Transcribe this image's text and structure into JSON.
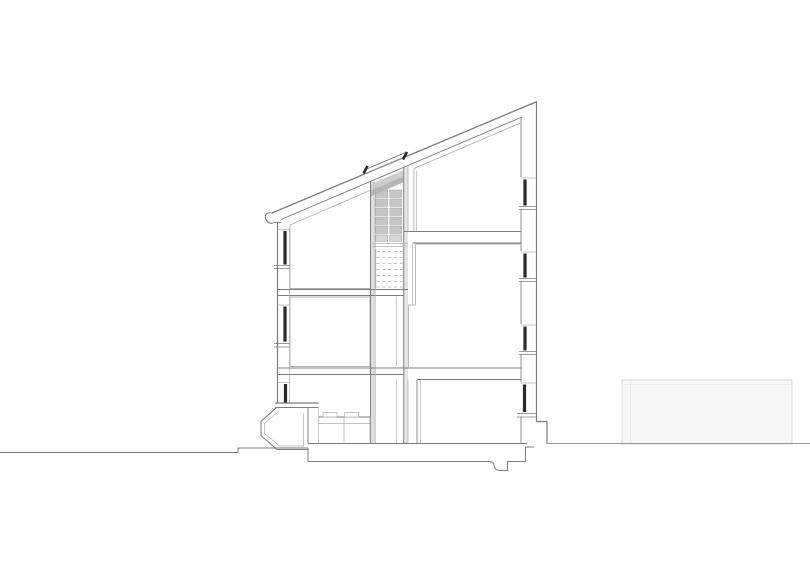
{
  "canvas": {
    "width": 810,
    "height": 570,
    "background": "#ffffff"
  },
  "drawing": {
    "kind": "architectural-building-cross-section",
    "colors": {
      "main": "#7d7d7d",
      "mid": "#989898",
      "light": "#b3b3b3",
      "faint": "#d8d8d4",
      "fainter": "#e6e6e2",
      "dark": "#2a2a2a",
      "white": "#ffffff",
      "none": "none",
      "shelf": "#c6c6c6",
      "shelf_last": "#d8d8d8",
      "band_left": "#dedede",
      "band_right": "#e4e4e4",
      "trap_light": "#cdcdcd",
      "trap_dark": "#b6b6b6",
      "neighbor": "#f7f7f5"
    },
    "layers": [
      {
        "type": "paths",
        "name": "background-context",
        "items": [
          {
            "n": "neighbor-building-block",
            "d": "M622,380 H792 V444 H622 Z",
            "s": "faint",
            "w": 1,
            "f": "neighbor"
          },
          {
            "n": "neighbor-building-parapet-line",
            "d": "M622,384.5 H792",
            "s": "fainter",
            "w": 0.8
          },
          {
            "n": "neighbor-building-edge-line",
            "d": "M630.5,380 V444",
            "s": "fainter",
            "w": 0.8
          },
          {
            "n": "ground-line-left",
            "d": "M0,452.5 H238 V448 H308",
            "s": "main",
            "w": 1.1
          },
          {
            "n": "ground-line-right",
            "d": "M547,443.5 H810",
            "s": "mid",
            "w": 1
          }
        ]
      },
      {
        "type": "paths",
        "name": "shaft-fills",
        "items": [
          {
            "n": "stair-shaft-left-wall-fill",
            "d": "M370.5,181.5 H375.2 V443 H370.5 Z",
            "s": "none",
            "w": 0,
            "f": "band_left"
          },
          {
            "n": "stair-shaft-right-wall-fill",
            "d": "M403.7,167.5 H408 V443 H403.7 Z",
            "s": "none",
            "w": 0,
            "f": "band_right"
          }
        ]
      },
      {
        "type": "grid",
        "name": "shelf-grid",
        "x": 375.8,
        "colOffsets": [
          0,
          14
        ],
        "colW": 11.8,
        "rowYs": [
          190,
          199,
          208,
          217,
          226,
          235
        ],
        "rowHs": [
          7.4,
          7.4,
          7.4,
          7.4,
          7.4,
          6.3
        ],
        "fills": [
          "shelf",
          "shelf",
          "shelf",
          "shelf",
          "shelf",
          "shelf_last"
        ],
        "stroke": "mid",
        "sw": 0.5
      },
      {
        "type": "paths",
        "name": "skylight-shaft-slope",
        "items": [
          {
            "n": "skylight-reveal-upper",
            "d": "M371,184 L403,170.5 V176.5 L371,190.5 Z",
            "s": "none",
            "w": 0,
            "f": "trap_light"
          },
          {
            "n": "skylight-reveal-lower",
            "d": "M371,190.5 L403,176.5 V182.5 L371,196.5 Z",
            "s": "none",
            "w": 0,
            "f": "trap_dark"
          }
        ]
      },
      {
        "type": "dashes",
        "name": "stair-run-panel",
        "x1": 376.5,
        "x2": 402.5,
        "ys": [
          251.5,
          257.5,
          263.5,
          269.5,
          275.5,
          281.5,
          287
        ],
        "stroke": "light",
        "w": 0.8,
        "dash": "3.2,2.6"
      },
      {
        "type": "paths",
        "name": "structure-lines",
        "items": [
          {
            "n": "roof-top-line",
            "d": "M272,213 L537,101.5",
            "s": "main",
            "w": 1.3
          },
          {
            "n": "roof-soffit-line",
            "d": "M281,219.5 L522,117",
            "s": "main",
            "w": 0.9
          },
          {
            "n": "gutter-hook",
            "d": "M273,213.5 C268,211.5 264.5,214 265.5,218.5 C266.5,222.5 271,224.5 273.5,222.5",
            "s": "main",
            "w": 1
          },
          {
            "n": "eave-underside",
            "d": "M273.5,222.5 H281.5",
            "s": "main",
            "w": 0.9
          },
          {
            "n": "left-wall-outer",
            "d": "M277.5,222 V403",
            "s": "main",
            "w": 1.2
          },
          {
            "n": "left-wall-inner",
            "d": "M289.5,227.5 V403",
            "s": "light",
            "w": 0.75
          },
          {
            "n": "attic-left-room-outline",
            "d": "M290,288.5 V225 L371,190 M290,288.5 H371",
            "s": "light",
            "w": 0.9
          },
          {
            "n": "slab-left-upper-top",
            "d": "M277.5,289.5 H408",
            "s": "main",
            "w": 0.95
          },
          {
            "n": "slab-left-upper-bottom",
            "d": "M277.5,295.5 H404",
            "s": "main",
            "w": 0.9
          },
          {
            "n": "mid-left-room-outline",
            "d": "M290,297 H370 V366.5 H290 Z",
            "s": "light",
            "w": 0.9
          },
          {
            "n": "slab-main-top",
            "d": "M277.5,368 H521",
            "s": "main",
            "w": 1
          },
          {
            "n": "slab-main-bottom-left",
            "d": "M277.5,374.5 H404",
            "s": "main",
            "w": 0.9
          },
          {
            "n": "slab-main-bottom-right",
            "d": "M417,379.5 H521",
            "s": "main",
            "w": 0.9
          },
          {
            "n": "ground-floor-line",
            "d": "M308,443.5 H527",
            "s": "main",
            "w": 1
          },
          {
            "n": "foundation-left-edge",
            "d": "M308,448 V461.5",
            "s": "main",
            "w": 1
          },
          {
            "n": "foundation-bottom-profile",
            "d": "M308,461.5 H489 C493,461.5 494,463.5 494.5,466.5 C495,469.5 497,470.5 500.5,470.5 H507.5 V461.5 H525.5 V447 H534",
            "s": "main",
            "w": 1
          },
          {
            "n": "right-wall-outer",
            "d": "M536.5,101.5 V421.5 H547 V443.5",
            "s": "main",
            "w": 1.2
          },
          {
            "n": "right-wall-inner-segments",
            "d": "M521,117 V177 M521,209.5 V251 M521,281.5 V324 M521,354.5 V382 M521,416.5 V443",
            "s": "main",
            "w": 0.85
          },
          {
            "n": "attic-right-room-outline",
            "d": "M414,168.5 L521.5,122.5 M414,168.5 V231",
            "s": "light",
            "w": 0.9
          },
          {
            "n": "attic-right-wall-inner",
            "d": "M416.5,171 V231",
            "s": "light",
            "w": 0.7
          },
          {
            "n": "slab-right-upper-top",
            "d": "M404,231.5 H521",
            "s": "main",
            "w": 1
          },
          {
            "n": "slab-right-upper-bottom",
            "d": "M412.5,243 H521.5",
            "s": "main",
            "w": 0.9
          },
          {
            "n": "mid-right-room-outline",
            "d": "M521,244 H415.5 V305 H408.5 V368",
            "s": "light",
            "w": 0.9
          },
          {
            "n": "mid-right-wall-inner",
            "d": "M412.5,244 V305",
            "s": "light",
            "w": 0.7
          },
          {
            "n": "ground-right-partition",
            "d": "M417,380 V443",
            "s": "main",
            "w": 0.9
          },
          {
            "n": "ground-right-partition-inner",
            "d": "M420.5,380 V443",
            "s": "light",
            "w": 0.7
          },
          {
            "n": "shaft-left-wall-line",
            "d": "M370.5,181.5 V443",
            "s": "main",
            "w": 0.95
          },
          {
            "n": "shaft-left-wall-line-inner",
            "d": "M375.2,186.5 V443",
            "s": "light",
            "w": 0.75
          },
          {
            "n": "shaft-right-wall-line",
            "d": "M403.7,167.5 V443",
            "s": "main",
            "w": 0.95
          },
          {
            "n": "shaft-right-wall-aux",
            "d": "M408,166 V231.5 M408,380 V443",
            "s": "light",
            "w": 0.75
          },
          {
            "n": "shaft-mid-aux",
            "d": "M396.5,297 V366.5 M396.5,380 V443",
            "s": "light",
            "w": 0.7
          },
          {
            "n": "skylight-glass-line",
            "d": "M365.5,169.5 L405.5,152.5",
            "s": "main",
            "w": 0.9
          },
          {
            "n": "skylight-frame-line",
            "d": "M367,173 L404.5,157",
            "s": "mid",
            "w": 1.3
          },
          {
            "n": "entry-canopy-top",
            "d": "M275,403 H318.5",
            "s": "main",
            "w": 1.2
          },
          {
            "n": "entry-canopy-bottom",
            "d": "M275,407.5 H318.5",
            "s": "main",
            "w": 0.9
          },
          {
            "n": "entry-porch-outer",
            "d": "M276.5,407.5 L261,421.5 V435.5 L277,449.5 H307.5",
            "s": "main",
            "w": 1
          },
          {
            "n": "entry-porch-inner",
            "d": "M279,411 L264.5,423.5 V433.5 L279.5,446 H303.5 V413",
            "s": "light",
            "w": 0.75
          },
          {
            "n": "entry-interior-wall",
            "d": "M308,407.5 V443.5",
            "s": "main",
            "w": 0.9
          },
          {
            "n": "entry-canopy-post",
            "d": "M318.5,407.5 V417",
            "s": "light",
            "w": 0.75
          },
          {
            "n": "kitchen-counter-top",
            "d": "M318.5,417 H370",
            "s": "main",
            "w": 0.9
          },
          {
            "n": "kitchen-counter-lines",
            "d": "M318.5,423.5 H370 M318.5,417 V443.5 M344,417 V443.5 M370,417 V443.5",
            "s": "light",
            "w": 0.75
          },
          {
            "n": "kitchen-box-1",
            "d": "M323,412.5 H337 V417 H323 Z",
            "s": "light",
            "w": 0.8,
            "f": "white"
          },
          {
            "n": "kitchen-box-2",
            "d": "M344.5,412.5 H358.5 V417 H344.5 Z",
            "s": "light",
            "w": 0.8,
            "f": "white"
          },
          {
            "n": "shelf-bottom-lines",
            "d": "M372,243.5 H408 M372,246.5 H408",
            "s": "light",
            "w": 0.75
          },
          {
            "n": "stair-panel-borders",
            "d": "M375.8,249 V289.5 M403.2,249 V289.5",
            "s": "light",
            "w": 0.7
          },
          {
            "n": "window-heads-left",
            "d": "M277.5,229.5 H290 M277.5,305 H290 M277.5,382.5 H290",
            "s": "light",
            "w": 0.8
          },
          {
            "n": "window-sill-left-1",
            "d": "M274,265.5 H290 M274,268.5 H290",
            "s": "main",
            "w": 0.85
          },
          {
            "n": "window-sill-left-2",
            "d": "M274,343.5 H290 M274,347 H290",
            "s": "main",
            "w": 0.85
          },
          {
            "n": "window-heads-right",
            "d": "M521,178 H536 M521,252 H536 M521,325 H536 M521,383 H536",
            "s": "light",
            "w": 0.8
          },
          {
            "n": "window-sill-right-1",
            "d": "M519,206.5 H537 M519,209.5 H537",
            "s": "main",
            "w": 0.85
          },
          {
            "n": "window-sill-right-2",
            "d": "M519,278.5 H537 M519,281.5 H537",
            "s": "main",
            "w": 0.85
          },
          {
            "n": "window-sill-right-3",
            "d": "M519,351.5 H537 M519,354.5 H537",
            "s": "main",
            "w": 0.85
          },
          {
            "n": "window-sill-right-4",
            "d": "M517,413.5 H536 M517,417 H536",
            "s": "main",
            "w": 0.85
          }
        ]
      },
      {
        "type": "paths",
        "name": "glazing-and-frames",
        "items": [
          {
            "n": "window-glazing-left-1",
            "d": "M285,231 V264.5",
            "s": "dark",
            "w": 3.2
          },
          {
            "n": "window-glazing-left-2",
            "d": "M285,306.5 V341.5",
            "s": "dark",
            "w": 3.2
          },
          {
            "n": "window-glazing-left-3",
            "d": "M285.5,384 V402.5",
            "s": "dark",
            "w": 3.2
          },
          {
            "n": "window-glazing-right-1",
            "d": "M525,179.5 V205.5",
            "s": "dark",
            "w": 3.2
          },
          {
            "n": "window-glazing-right-2",
            "d": "M525,253.5 V277.5",
            "s": "dark",
            "w": 3.2
          },
          {
            "n": "window-glazing-right-3",
            "d": "M525,326.5 V350.5",
            "s": "dark",
            "w": 3.2
          },
          {
            "n": "window-glazing-right-4",
            "d": "M524.5,384.5 V412",
            "s": "dark",
            "w": 3.2
          },
          {
            "n": "skylight-cap-left",
            "d": "M363.5,173.5 L367.5,166",
            "s": "dark",
            "w": 2.6
          },
          {
            "n": "skylight-cap-right",
            "d": "M403,159.5 L407,152",
            "s": "dark",
            "w": 2.6
          }
        ]
      }
    ]
  }
}
